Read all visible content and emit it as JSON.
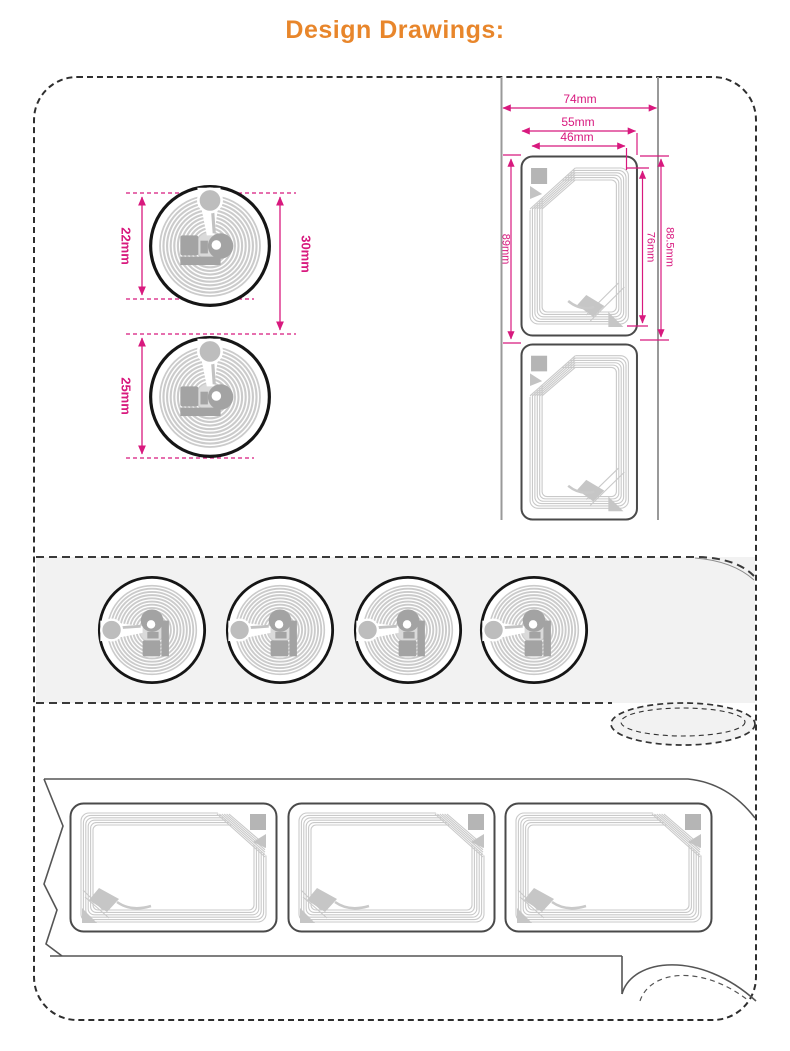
{
  "title": {
    "text": "Design Drawings:"
  },
  "colors": {
    "accent_orange": "#E8862B",
    "dimension_pink": "#D8197E",
    "strip_gray": "#f2f2f2",
    "line_gray": "#999999"
  },
  "round_tag_dims": {
    "coil_diameter": "22mm",
    "label_pitch": "30mm",
    "label_diameter": "25mm"
  },
  "rect_tag_dims": {
    "tape_width": "74mm",
    "label_width": "55mm",
    "antenna_width": "46mm",
    "label_height": "89mm",
    "antenna_height": "76mm",
    "label_pitch": "88.5mm"
  }
}
